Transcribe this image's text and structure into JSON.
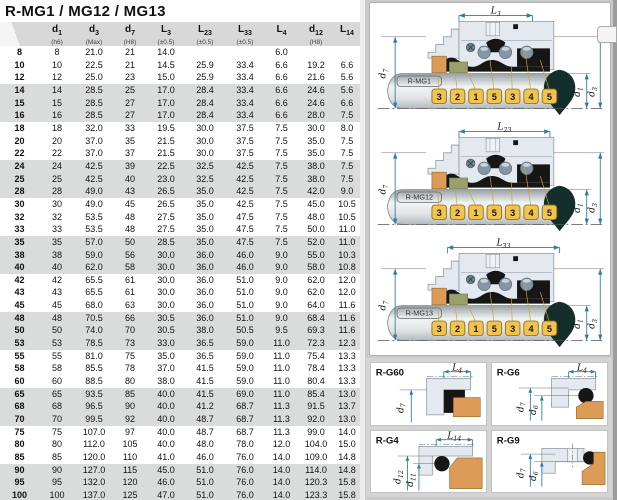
{
  "title": "R-MG1 / MG12 / MG13",
  "table": {
    "headers": [
      {
        "base": "",
        "sub": "",
        "note": ""
      },
      {
        "base": "d",
        "sub": "1",
        "note": "(h6)"
      },
      {
        "base": "d",
        "sub": "3",
        "note": "(Max)"
      },
      {
        "base": "d",
        "sub": "7",
        "note": "(H8)"
      },
      {
        "base": "L",
        "sub": "3",
        "note": "(±0.5)"
      },
      {
        "base": "L",
        "sub": "23",
        "note": "(±0.5)"
      },
      {
        "base": "L",
        "sub": "33",
        "note": "(±0.5)"
      },
      {
        "base": "L",
        "sub": "4",
        "note": ""
      },
      {
        "base": "d",
        "sub": "12",
        "note": "(H8)"
      },
      {
        "base": "L",
        "sub": "14",
        "note": ""
      }
    ],
    "rows": [
      [
        "8",
        "8",
        "21.0",
        "21",
        "14.0",
        "",
        "",
        "6.0",
        "",
        ""
      ],
      [
        "10",
        "10",
        "22.5",
        "21",
        "14.5",
        "25.9",
        "33.4",
        "6.6",
        "19.2",
        "6.6"
      ],
      [
        "12",
        "12",
        "25.0",
        "23",
        "15.0",
        "25.9",
        "33.4",
        "6.6",
        "21.6",
        "5.6"
      ],
      [
        "14",
        "14",
        "28.5",
        "25",
        "17.0",
        "28.4",
        "33.4",
        "6.6",
        "24.6",
        "5.6"
      ],
      [
        "15",
        "15",
        "28.5",
        "27",
        "17.0",
        "28.4",
        "33.4",
        "6.6",
        "24.6",
        "6.6"
      ],
      [
        "16",
        "16",
        "28.5",
        "27",
        "17.0",
        "28.4",
        "33.4",
        "6.6",
        "28.0",
        "7.5"
      ],
      [
        "18",
        "18",
        "32.0",
        "33",
        "19.5",
        "30.0",
        "37.5",
        "7.5",
        "30.0",
        "8.0"
      ],
      [
        "20",
        "20",
        "37.0",
        "35",
        "21.5",
        "30.0",
        "37.5",
        "7.5",
        "35.0",
        "7.5"
      ],
      [
        "22",
        "22",
        "37.0",
        "37",
        "21.5",
        "30.0",
        "37.5",
        "7.5",
        "35.0",
        "7.5"
      ],
      [
        "24",
        "24",
        "42.5",
        "39",
        "22.5",
        "32.5",
        "42.5",
        "7.5",
        "38.0",
        "7.5"
      ],
      [
        "25",
        "25",
        "42.5",
        "40",
        "23.0",
        "32.5",
        "42.5",
        "7.5",
        "38.0",
        "7.5"
      ],
      [
        "28",
        "28",
        "49.0",
        "43",
        "26.5",
        "35.0",
        "42.5",
        "7.5",
        "42.0",
        "9.0"
      ],
      [
        "30",
        "30",
        "49.0",
        "45",
        "26.5",
        "35.0",
        "42.5",
        "7.5",
        "45.0",
        "10.5"
      ],
      [
        "32",
        "32",
        "53.5",
        "48",
        "27.5",
        "35.0",
        "47.5",
        "7.5",
        "48.0",
        "10.5"
      ],
      [
        "33",
        "33",
        "53.5",
        "48",
        "27.5",
        "35.0",
        "47.5",
        "7.5",
        "50.0",
        "11.0"
      ],
      [
        "35",
        "35",
        "57.0",
        "50",
        "28.5",
        "35.0",
        "47.5",
        "7.5",
        "52.0",
        "11.0"
      ],
      [
        "38",
        "38",
        "59.0",
        "56",
        "30.0",
        "36.0",
        "46.0",
        "9.0",
        "55.0",
        "10.3"
      ],
      [
        "40",
        "40",
        "62.0",
        "58",
        "30.0",
        "36.0",
        "46.0",
        "9.0",
        "58.0",
        "10.8"
      ],
      [
        "42",
        "42",
        "65.5",
        "61",
        "30.0",
        "36.0",
        "51.0",
        "9.0",
        "62.0",
        "12.0"
      ],
      [
        "43",
        "43",
        "65.5",
        "61",
        "30.0",
        "36.0",
        "51.0",
        "9.0",
        "62.0",
        "12.0"
      ],
      [
        "45",
        "45",
        "68.0",
        "63",
        "30.0",
        "36.0",
        "51.0",
        "9.0",
        "64.0",
        "11.6"
      ],
      [
        "48",
        "48",
        "70.5",
        "66",
        "30.5",
        "36.0",
        "51.0",
        "9.0",
        "68.4",
        "11.6"
      ],
      [
        "50",
        "50",
        "74.0",
        "70",
        "30.5",
        "38.0",
        "50.5",
        "9.5",
        "69.3",
        "11.6"
      ],
      [
        "53",
        "53",
        "78.5",
        "73",
        "33.0",
        "36.5",
        "59.0",
        "11.0",
        "72.3",
        "12.3"
      ],
      [
        "55",
        "55",
        "81.0",
        "75",
        "35.0",
        "36.5",
        "59.0",
        "11.0",
        "75.4",
        "13.3"
      ],
      [
        "58",
        "58",
        "85.5",
        "78",
        "37.0",
        "41.5",
        "59.0",
        "11.0",
        "78.4",
        "13.3"
      ],
      [
        "60",
        "60",
        "88.5",
        "80",
        "38.0",
        "41.5",
        "59.0",
        "11.0",
        "80.4",
        "13.3"
      ],
      [
        "65",
        "65",
        "93.5",
        "85",
        "40.0",
        "41.5",
        "69.0",
        "11.0",
        "85.4",
        "13.0"
      ],
      [
        "68",
        "68",
        "96.5",
        "90",
        "40.0",
        "41.2",
        "68.7",
        "11.3",
        "91.5",
        "13.7"
      ],
      [
        "70",
        "70",
        "99.5",
        "92",
        "40.0",
        "48.7",
        "68.7",
        "11.3",
        "92.0",
        "13.0"
      ],
      [
        "75",
        "75",
        "107.0",
        "97",
        "40.0",
        "48.7",
        "68.7",
        "11.3",
        "99.0",
        "14.0"
      ],
      [
        "80",
        "80",
        "112.0",
        "105",
        "40.0",
        "48.0",
        "78.0",
        "12.0",
        "104.0",
        "15.0"
      ],
      [
        "85",
        "85",
        "120.0",
        "110",
        "41.0",
        "46.0",
        "76.0",
        "14.0",
        "109.0",
        "14.8"
      ],
      [
        "90",
        "90",
        "127.0",
        "115",
        "45.0",
        "51.0",
        "76.0",
        "14.0",
        "114.0",
        "14.8"
      ],
      [
        "95",
        "95",
        "132.0",
        "120",
        "46.0",
        "51.0",
        "76.0",
        "14.0",
        "120.3",
        "15.8"
      ],
      [
        "100",
        "100",
        "137.0",
        "125",
        "47.0",
        "51.0",
        "76.0",
        "14.0",
        "123.3",
        "15.8"
      ]
    ]
  },
  "diagrams": [
    {
      "label": "R-MG1",
      "top_dim": {
        "base": "L",
        "sub": "3"
      },
      "left_dim": {
        "base": "d",
        "sub": "7"
      },
      "right_dim_inner": {
        "base": "d",
        "sub": "1"
      },
      "right_dim_outer": {
        "base": "d",
        "sub": "3"
      },
      "balloons": [
        "3",
        "2",
        "1",
        "5",
        "3",
        "4",
        "5"
      ]
    },
    {
      "label": "R-MG12",
      "top_dim": {
        "base": "L",
        "sub": "23"
      },
      "left_dim": {
        "base": "d",
        "sub": "7"
      },
      "right_dim_inner": {
        "base": "d",
        "sub": "1"
      },
      "right_dim_outer": {
        "base": "d",
        "sub": "3"
      },
      "balloons": [
        "3",
        "2",
        "1",
        "5",
        "3",
        "4",
        "5"
      ]
    },
    {
      "label": "R-MG13",
      "top_dim": {
        "base": "L",
        "sub": "33"
      },
      "left_dim": {
        "base": "d",
        "sub": "7"
      },
      "right_dim_inner": {
        "base": "d",
        "sub": "1"
      },
      "right_dim_outer": {
        "base": "d",
        "sub": "3"
      },
      "balloons": [
        "3",
        "2",
        "1",
        "5",
        "3",
        "4",
        "5"
      ]
    }
  ],
  "seats": [
    {
      "label": "R-G60",
      "top_dim": {
        "base": "L",
        "sub": "4"
      },
      "left_dims": [
        {
          "base": "d",
          "sub": "7"
        }
      ]
    },
    {
      "label": "R-G6",
      "top_dim": {
        "base": "L",
        "sub": "4"
      },
      "left_dims": [
        {
          "base": "d",
          "sub": "7"
        },
        {
          "base": "d",
          "sub": "6"
        }
      ]
    },
    {
      "label": "R-G4",
      "top_dim": {
        "base": "L",
        "sub": "14"
      },
      "left_dims": [
        {
          "base": "d",
          "sub": "12"
        },
        {
          "base": "d",
          "sub": "11"
        }
      ]
    },
    {
      "label": "R-G9",
      "left_dims": [
        {
          "base": "d",
          "sub": "7"
        },
        {
          "base": "d",
          "sub": "6"
        }
      ]
    }
  ],
  "colors": {
    "dimension_line": "#2d7ba8",
    "balloon_fill": "#f2c44f",
    "balloon_border": "#96761c",
    "orange_part": "#dc9c58",
    "olive_part": "#9aa06c",
    "housing_fill": "#e3e9ef",
    "housing_line": "#8d99a3",
    "black_part": "#161616",
    "pointer_dark": "#132e2b",
    "row_band": "#dadbdb",
    "header_bg": "#d8d8d8"
  }
}
